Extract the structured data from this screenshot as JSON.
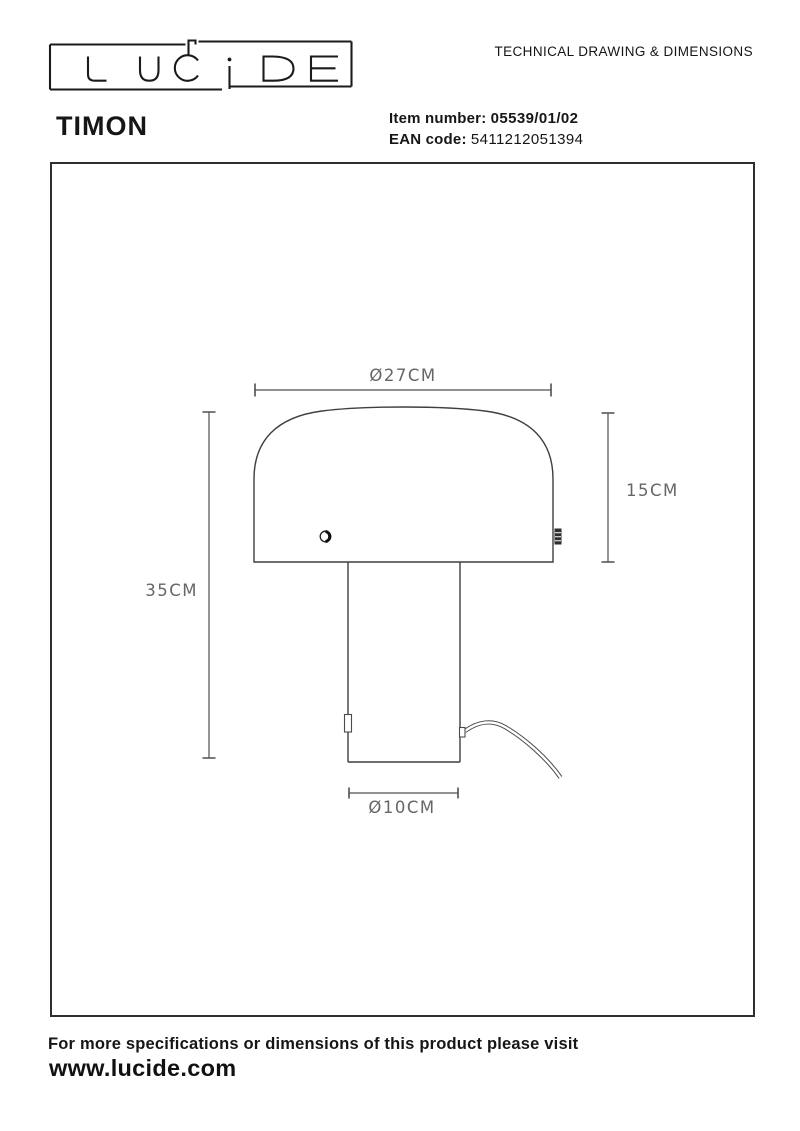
{
  "header": {
    "logo_text": "LUCIDE",
    "doc_title": "TECHNICAL DRAWING & DIMENSIONS",
    "product_name": "TIMON",
    "item_number_label": "Item number:",
    "item_number": "05539/01/02",
    "ean_label": "EAN code:",
    "ean": "5411212051394"
  },
  "drawing": {
    "dimensions": {
      "shade_diameter": "Ø27CM",
      "shade_height": "15CM",
      "total_height": "35CM",
      "base_diameter": "Ø10CM"
    }
  },
  "footer": {
    "note": "For more specifications or dimensions of this product please visit",
    "website": "www.lucide.com"
  },
  "colors": {
    "ink": "#161616",
    "outline": "#3f3f3f",
    "dimension_line": "#4f4f4f",
    "dimension_text": "#666666"
  }
}
